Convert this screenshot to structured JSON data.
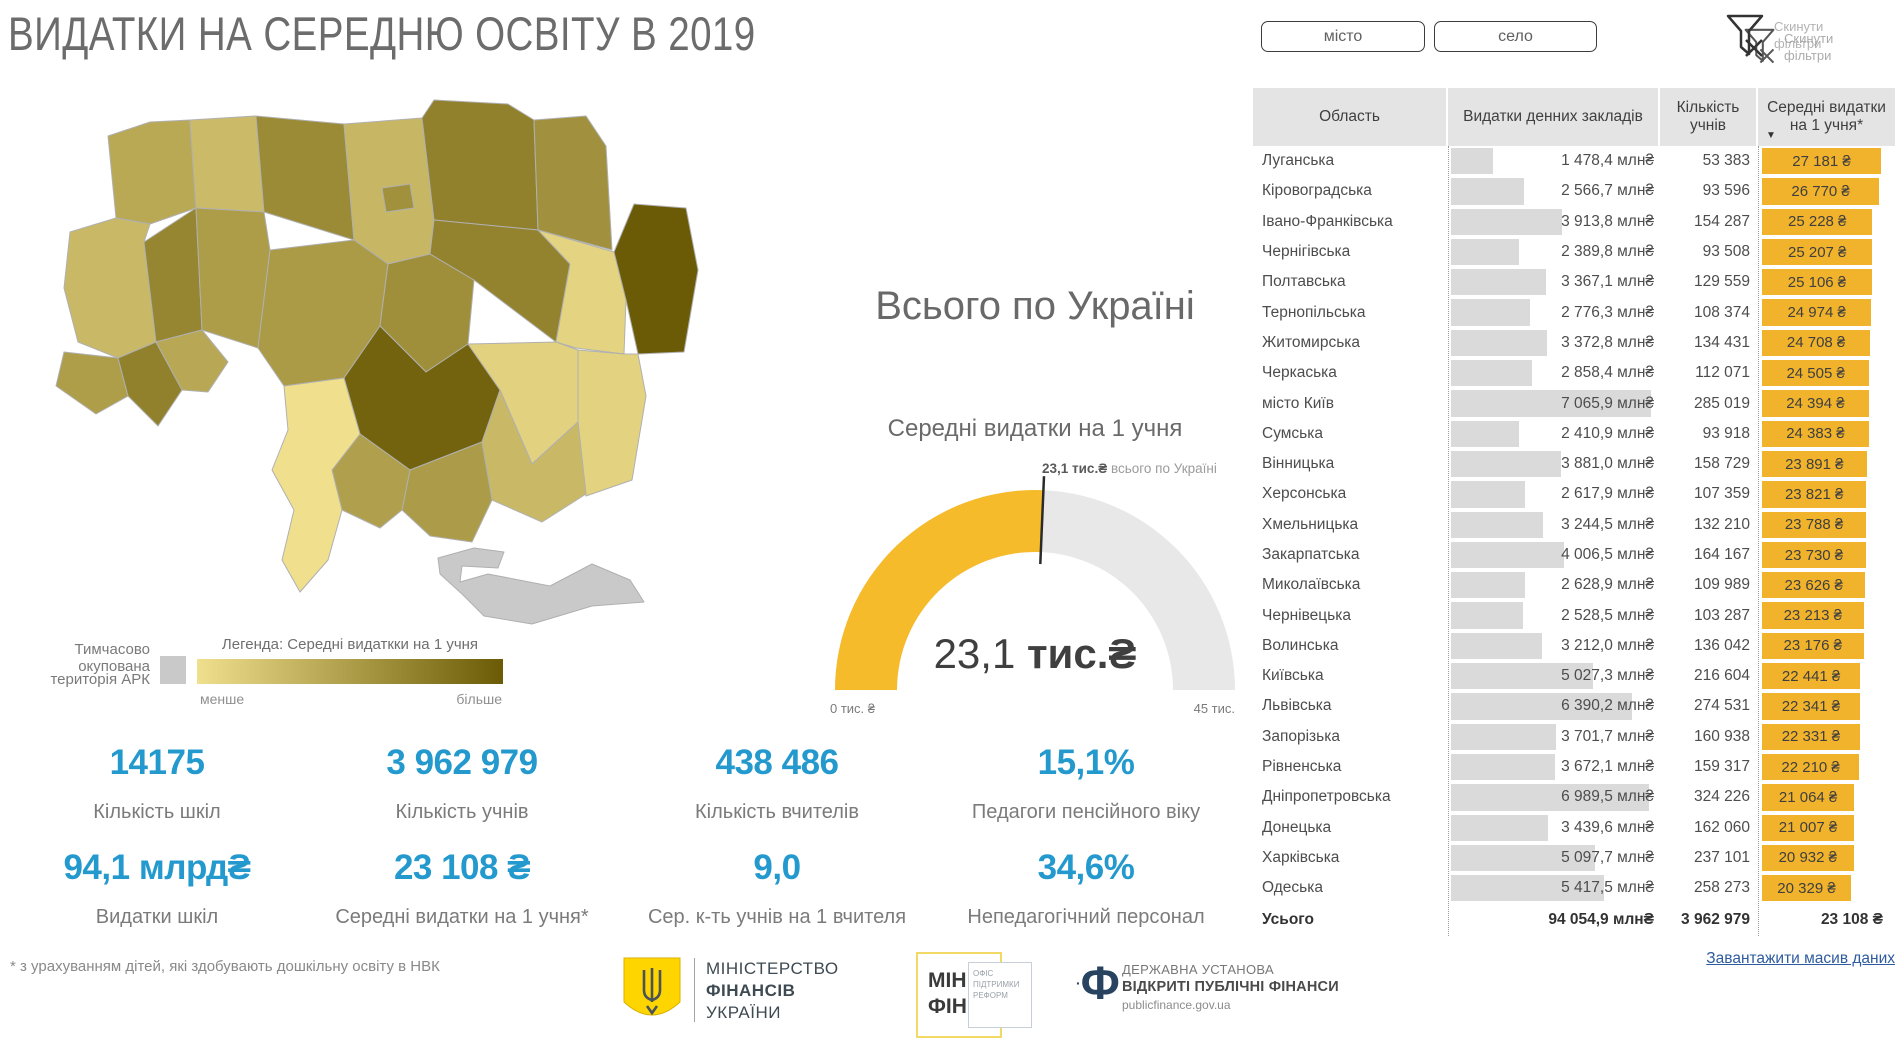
{
  "header": {
    "title": "ВИДАТКИ НА СЕРЕДНЮ ОСВІТУ В 2019"
  },
  "filters": {
    "city_label": "місто",
    "village_label": "село",
    "reset_line1": "Скинути",
    "reset_line2": "фільтри"
  },
  "map_legend": {
    "occupied_line1": "Тимчасово окупована",
    "occupied_line2": "територія АРК",
    "title": "Легенда: Середні видаткки на 1 учня",
    "less_label": "менше",
    "more_label": "більше"
  },
  "gauge_text": {
    "panel_title": "Всього по Україні",
    "subtitle": "Середні видатки на 1 учня",
    "callout_value": "23,1 тис.₴",
    "callout_suffix": " всього по Україні",
    "center_value": "23,1",
    "center_unit": " тис.₴",
    "min_label": "0 тис. ₴",
    "max_label": "45 тис."
  },
  "kpis": [
    {
      "value": "14175",
      "label": "Кількість шкіл"
    },
    {
      "value": "3 962 979",
      "label": "Кількість учнів"
    },
    {
      "value": "438 486",
      "label": "Кількість вчителів"
    },
    {
      "value": "15,1%",
      "label": "Педагоги пенсійного віку"
    },
    {
      "value": "94,1 млрд₴",
      "label": "Видатки шкіл"
    },
    {
      "value": "23 108 ₴",
      "label": "Середні видатки на 1 учня*"
    },
    {
      "value": "9,0",
      "label": "Сер. к-ть учнів на 1 вчителя"
    },
    {
      "value": "34,6%",
      "label": "Непедагогічний персонал"
    }
  ],
  "table": {
    "headers": [
      "Область",
      "Видатки денних закладів",
      "Кількість учнів",
      "Середні видатки на 1 учня*"
    ]
  },
  "footnote": "* з урахуванням дітей, які здобувають дошкільну освіту в НВК",
  "download_link": "Завантажити масив даних",
  "footer": {
    "minfin_line1": "МІНІСТЕРСТВО",
    "minfin_line2": "ФІНАНСІВ",
    "minfin_line3": "УКРАЇНИ",
    "minfin2_line1": "МІН",
    "minfin2_line2": "ФІН",
    "opr_line1": "ОФІС",
    "opr_line2": "ПІДТРИМКИ",
    "opr_line3": "РЕФОРМ",
    "opf_glyph": "Ф",
    "opf_line1": "ДЕРЖАВНА УСТАНОВА",
    "opf_line2": "ВІДКРИТІ ПУБЛІЧНІ ФІНАНСИ",
    "opf_line3": "publicfinance.gov.ua"
  },
  "colors": {
    "accent_blue": "#2499ce",
    "bar_yellow": "#f1b32b",
    "gauge_yellow": "#f6bb2a",
    "gauge_track": "#e8e8e8",
    "link_blue": "#2e5b9f",
    "title_gray": "#6c6c6c"
  },
  "chart_data": [
    {
      "type": "gauge",
      "title": "Всього по Україні",
      "subtitle": "Середні видатки на 1 учня",
      "value": 23.1,
      "min": 0,
      "max": 45,
      "unit": "тис.₴",
      "min_label": "0 тис. ₴",
      "max_label": "45 тис.",
      "callout": "23,1 тис.₴ всього по Україні",
      "fill_color": "#f6bb2a",
      "track_color": "#e8e8e8"
    },
    {
      "type": "choropleth",
      "title": "Легенда: Середні видаткки на 1 учня",
      "metric": "Середні видатки на 1 учня, ₴",
      "scale": {
        "min_label": "менше",
        "max_label": "більше",
        "min_color": "#f0e08e",
        "max_color": "#6b5b06"
      },
      "no_data_color": "#c9c9c9",
      "no_data_label": "Тимчасово окупована територія АРК",
      "regions": [
        {
          "key": "volynska",
          "name": "Волинська",
          "value": 23176
        },
        {
          "key": "rivnenska",
          "name": "Рівненська",
          "value": 22210
        },
        {
          "key": "zhytomyrska",
          "name": "Житомирська",
          "value": 24708
        },
        {
          "key": "kyivska",
          "name": "Київська",
          "value": 22441
        },
        {
          "key": "kyiv_city",
          "name": "місто Київ",
          "value": 24394
        },
        {
          "key": "chernihivska",
          "name": "Чернігівська",
          "value": 25207
        },
        {
          "key": "sumska",
          "name": "Сумська",
          "value": 24383
        },
        {
          "key": "lvivska",
          "name": "Львівська",
          "value": 22341
        },
        {
          "key": "ternopilska",
          "name": "Тернопільська",
          "value": 24974
        },
        {
          "key": "khmelnytska",
          "name": "Хмельницька",
          "value": 23788
        },
        {
          "key": "vinnytska",
          "name": "Вінницька",
          "value": 23891
        },
        {
          "key": "zakarpatska",
          "name": "Закарпатська",
          "value": 23730
        },
        {
          "key": "ivano_frankivska",
          "name": "Івано-Франківська",
          "value": 25228
        },
        {
          "key": "chernivetska",
          "name": "Чернівецька",
          "value": 23213
        },
        {
          "key": "cherkaska",
          "name": "Черкаська",
          "value": 24505
        },
        {
          "key": "poltavska",
          "name": "Полтавська",
          "value": 25106
        },
        {
          "key": "kharkivska",
          "name": "Харківська",
          "value": 20932
        },
        {
          "key": "luhanska",
          "name": "Луганська",
          "value": 27181
        },
        {
          "key": "kirovohradska",
          "name": "Кіровоградська",
          "value": 26770
        },
        {
          "key": "dnipropetrovska",
          "name": "Дніпропетровська",
          "value": 21064
        },
        {
          "key": "donetska",
          "name": "Донецька",
          "value": 21007
        },
        {
          "key": "zaporizka",
          "name": "Запорізька",
          "value": 22331
        },
        {
          "key": "khersonska",
          "name": "Херсонська",
          "value": 23821
        },
        {
          "key": "mykolaivska",
          "name": "Миколаївська",
          "value": 23626
        },
        {
          "key": "odeska",
          "name": "Одеська",
          "value": 20329
        },
        {
          "key": "crimea",
          "name": "Тимчасово окупована територія АРК",
          "value": null
        }
      ]
    },
    {
      "type": "table",
      "columns": [
        "Область",
        "Видатки денних закладів",
        "Кількість учнів",
        "Середні видатки на 1 учня*"
      ],
      "sort": {
        "column": "Середні видатки на 1 учня*",
        "direction": "desc"
      },
      "rows": [
        {
          "region": "Луганська",
          "spend": "1 478,4 млн₴",
          "spend_mln": 1478.4,
          "pupils": "53 383",
          "avg": "27 181 ₴",
          "avg_uah": 27181
        },
        {
          "region": "Кіровоградська",
          "spend": "2 566,7 млн₴",
          "spend_mln": 2566.7,
          "pupils": "93 596",
          "avg": "26 770 ₴",
          "avg_uah": 26770
        },
        {
          "region": "Івано-Франківська",
          "spend": "3 913,8 млн₴",
          "spend_mln": 3913.8,
          "pupils": "154 287",
          "avg": "25 228 ₴",
          "avg_uah": 25228
        },
        {
          "region": "Чернігівська",
          "spend": "2 389,8 млн₴",
          "spend_mln": 2389.8,
          "pupils": "93 508",
          "avg": "25 207 ₴",
          "avg_uah": 25207
        },
        {
          "region": "Полтавська",
          "spend": "3 367,1 млн₴",
          "spend_mln": 3367.1,
          "pupils": "129 559",
          "avg": "25 106 ₴",
          "avg_uah": 25106
        },
        {
          "region": "Тернопільська",
          "spend": "2 776,3 млн₴",
          "spend_mln": 2776.3,
          "pupils": "108 374",
          "avg": "24 974 ₴",
          "avg_uah": 24974
        },
        {
          "region": "Житомирська",
          "spend": "3 372,8 млн₴",
          "spend_mln": 3372.8,
          "pupils": "134 431",
          "avg": "24 708 ₴",
          "avg_uah": 24708
        },
        {
          "region": "Черкаська",
          "spend": "2 858,4 млн₴",
          "spend_mln": 2858.4,
          "pupils": "112 071",
          "avg": "24 505 ₴",
          "avg_uah": 24505
        },
        {
          "region": "місто Київ",
          "spend": "7 065,9 млн₴",
          "spend_mln": 7065.9,
          "pupils": "285 019",
          "avg": "24 394 ₴",
          "avg_uah": 24394
        },
        {
          "region": "Сумська",
          "spend": "2 410,9 млн₴",
          "spend_mln": 2410.9,
          "pupils": "93 918",
          "avg": "24 383 ₴",
          "avg_uah": 24383
        },
        {
          "region": "Вінницька",
          "spend": "3 881,0 млн₴",
          "spend_mln": 3881.0,
          "pupils": "158 729",
          "avg": "23 891 ₴",
          "avg_uah": 23891
        },
        {
          "region": "Херсонська",
          "spend": "2 617,9 млн₴",
          "spend_mln": 2617.9,
          "pupils": "107 359",
          "avg": "23 821 ₴",
          "avg_uah": 23821
        },
        {
          "region": "Хмельницька",
          "spend": "3 244,5 млн₴",
          "spend_mln": 3244.5,
          "pupils": "132 210",
          "avg": "23 788 ₴",
          "avg_uah": 23788
        },
        {
          "region": "Закарпатська",
          "spend": "4 006,5 млн₴",
          "spend_mln": 4006.5,
          "pupils": "164 167",
          "avg": "23 730 ₴",
          "avg_uah": 23730
        },
        {
          "region": "Миколаївська",
          "spend": "2 628,9 млн₴",
          "spend_mln": 2628.9,
          "pupils": "109 989",
          "avg": "23 626 ₴",
          "avg_uah": 23626
        },
        {
          "region": "Чернівецька",
          "spend": "2 528,5 млн₴",
          "spend_mln": 2528.5,
          "pupils": "103 287",
          "avg": "23 213 ₴",
          "avg_uah": 23213
        },
        {
          "region": "Волинська",
          "spend": "3 212,0 млн₴",
          "spend_mln": 3212.0,
          "pupils": "136 042",
          "avg": "23 176 ₴",
          "avg_uah": 23176
        },
        {
          "region": "Київська",
          "spend": "5 027,3 млн₴",
          "spend_mln": 5027.3,
          "pupils": "216 604",
          "avg": "22 441 ₴",
          "avg_uah": 22441
        },
        {
          "region": "Львівська",
          "spend": "6 390,2 млн₴",
          "spend_mln": 6390.2,
          "pupils": "274 531",
          "avg": "22 341 ₴",
          "avg_uah": 22341
        },
        {
          "region": "Запорізька",
          "spend": "3 701,7 млн₴",
          "spend_mln": 3701.7,
          "pupils": "160 938",
          "avg": "22 331 ₴",
          "avg_uah": 22331
        },
        {
          "region": "Рівненська",
          "spend": "3 672,1 млн₴",
          "spend_mln": 3672.1,
          "pupils": "159 317",
          "avg": "22 210 ₴",
          "avg_uah": 22210
        },
        {
          "region": "Дніпропетровська",
          "spend": "6 989,5 млн₴",
          "spend_mln": 6989.5,
          "pupils": "324 226",
          "avg": "21 064 ₴",
          "avg_uah": 21064
        },
        {
          "region": "Донецька",
          "spend": "3 439,6 млн₴",
          "spend_mln": 3439.6,
          "pupils": "162 060",
          "avg": "21 007 ₴",
          "avg_uah": 21007
        },
        {
          "region": "Харківська",
          "spend": "5 097,7 млн₴",
          "spend_mln": 5097.7,
          "pupils": "237 101",
          "avg": "20 932 ₴",
          "avg_uah": 20932
        },
        {
          "region": "Одеська",
          "spend": "5 417,5 млн₴",
          "spend_mln": 5417.5,
          "pupils": "258 273",
          "avg": "20 329 ₴",
          "avg_uah": 20329
        }
      ],
      "total": {
        "region": "Усього",
        "spend": "94 054,9 млн₴",
        "pupils": "3 962 979",
        "avg": "23 108 ₴"
      }
    }
  ]
}
